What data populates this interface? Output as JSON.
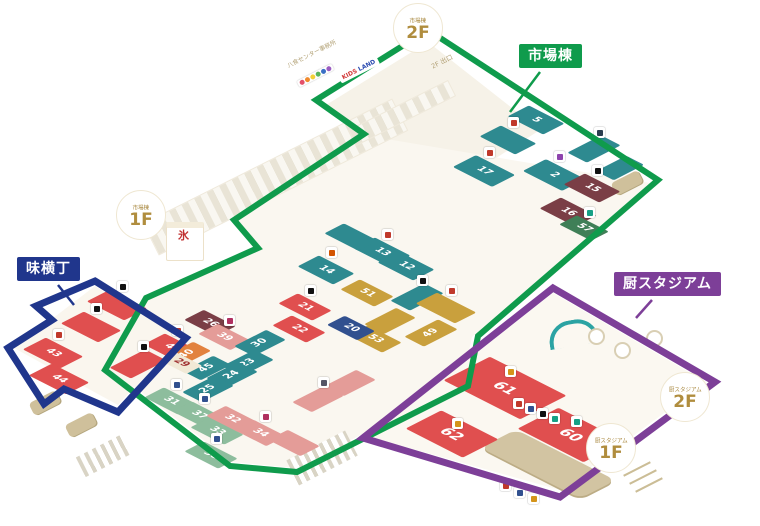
{
  "palette": {
    "teal": "#2e8a90",
    "red": "#e04f4f",
    "pink": "#e49c98",
    "maroon": "#7a3e46",
    "gold": "#c9a03d",
    "green": "#3f7f57",
    "lgreen": "#8dbd9d",
    "orange": "#e2823e",
    "navy": "#31508f",
    "cream": "#f1e9d6"
  },
  "regions": [
    {
      "name": "市場棟",
      "color": "#0f9b4c",
      "stroke": 6,
      "polygon": "428,30 316,100 364,134 234,220 258,248 146,298 105,370 230,466 297,472 468,386 478,336 658,180",
      "pointer": {
        "x1": 540,
        "y1": 72,
        "x2": 510,
        "y2": 112
      }
    },
    {
      "name": "味横丁",
      "color": "#20368c",
      "stroke": 7,
      "polygon": "95,281 186,338 118,412 64,389 44,404 8,348 52,320 36,306",
      "pointer": {
        "x1": 58,
        "y1": 285,
        "x2": 74,
        "y2": 305
      }
    },
    {
      "name": "厨スタジアム",
      "color": "#7d3f98",
      "stroke": 7,
      "polygon": "553,288 715,382 560,497 363,438",
      "pointer": {
        "x1": 652,
        "y1": 300,
        "x2": 636,
        "y2": 318
      }
    }
  ],
  "floors": [
    {
      "points": "428,42 326,105 452,186 540,130",
      "fill": "#f6f2e8"
    },
    {
      "points": "368,136 236,219 258,248 148,298 110,368 232,462 296,468 462,383 472,337 650,183",
      "fill": "#faf7f0"
    },
    {
      "points": "95,286 179,338 118,405 14,348",
      "fill": "#faf6ee"
    },
    {
      "points": "553,293 706,382 560,490 370,437",
      "fill": "#fbf8f1"
    }
  ],
  "badges": [
    {
      "building": "市場棟",
      "floor": "2F",
      "x": 393,
      "y": 3
    },
    {
      "building": "市場棟",
      "floor": "1F",
      "x": 116,
      "y": 190
    },
    {
      "building": "厨スタジアム",
      "floor": "2F",
      "x": 660,
      "y": 372
    },
    {
      "building": "厨スタジアム",
      "floor": "1F",
      "x": 586,
      "y": 423
    }
  ],
  "annotations": [
    {
      "text": "八食センター事務所",
      "x": 288,
      "y": 64,
      "rot": -27,
      "size": 6,
      "color": "#b3a277"
    },
    {
      "text": "2F 出口",
      "x": 432,
      "y": 64,
      "rot": -27,
      "size": 6.5,
      "color": "#b3a277"
    },
    {
      "text": "氷",
      "x": 178,
      "y": 230,
      "rot": 0,
      "size": 11,
      "color": "#c03030",
      "bold": true
    },
    {
      "text": "KIDS LAND",
      "x": 340,
      "y": 76,
      "rot": -27,
      "size": 6,
      "style": "kids"
    }
  ],
  "stalls": [
    {
      "n": "",
      "x": 488,
      "y": 128,
      "w": 40,
      "h": 24,
      "c": "teal",
      "d": "b",
      "chip": "#c0392b"
    },
    {
      "n": "5",
      "x": 516,
      "y": 108,
      "w": 40,
      "h": 24,
      "c": "teal",
      "d": "b"
    },
    {
      "n": "2",
      "x": 532,
      "y": 162,
      "w": 44,
      "h": 26,
      "c": "teal",
      "d": "b",
      "chip": "#8e44ad"
    },
    {
      "n": "17",
      "x": 462,
      "y": 158,
      "w": 44,
      "h": 26,
      "c": "teal",
      "d": "b",
      "chip": "#c0392b"
    },
    {
      "n": "",
      "x": 575,
      "y": 138,
      "w": 38,
      "h": 22,
      "c": "teal",
      "d": "a",
      "chip": "#2c3e50"
    },
    {
      "n": "",
      "x": 603,
      "y": 158,
      "w": 34,
      "h": 20,
      "c": "teal",
      "d": "a"
    },
    {
      "n": "15",
      "x": 572,
      "y": 176,
      "w": 40,
      "h": 24,
      "c": "maroon",
      "d": "b",
      "chip": "#111111"
    },
    {
      "n": "16",
      "x": 548,
      "y": 200,
      "w": 40,
      "h": 24,
      "c": "maroon",
      "d": "b"
    },
    {
      "n": "57",
      "x": 566,
      "y": 218,
      "w": 36,
      "h": 20,
      "c": "green",
      "d": "b",
      "chip": "#16a085"
    },
    {
      "n": "13",
      "x": 362,
      "y": 240,
      "w": 40,
      "h": 24,
      "c": "teal",
      "d": "b",
      "chip": "#c0392b"
    },
    {
      "n": "12",
      "x": 386,
      "y": 254,
      "w": 40,
      "h": 24,
      "c": "teal",
      "d": "b"
    },
    {
      "n": "14",
      "x": 306,
      "y": 258,
      "w": 40,
      "h": 24,
      "c": "teal",
      "d": "b",
      "chip": "#d35400"
    },
    {
      "n": "",
      "x": 332,
      "y": 226,
      "w": 38,
      "h": 22,
      "c": "teal",
      "d": "b"
    },
    {
      "n": "51",
      "x": 348,
      "y": 282,
      "w": 38,
      "h": 22,
      "c": "gold",
      "d": "b"
    },
    {
      "n": "",
      "x": 398,
      "y": 286,
      "w": 38,
      "h": 22,
      "c": "teal",
      "d": "a",
      "chip": "#111111"
    },
    {
      "n": "",
      "x": 372,
      "y": 310,
      "w": 36,
      "h": 22,
      "c": "gold",
      "d": "a"
    },
    {
      "n": "49",
      "x": 412,
      "y": 322,
      "w": 38,
      "h": 22,
      "c": "gold",
      "d": "a"
    },
    {
      "n": "53",
      "x": 356,
      "y": 328,
      "w": 38,
      "h": 22,
      "c": "gold",
      "d": "b"
    },
    {
      "n": "20",
      "x": 334,
      "y": 318,
      "w": 34,
      "h": 20,
      "c": "navy",
      "d": "b"
    },
    {
      "n": "21",
      "x": 286,
      "y": 296,
      "w": 38,
      "h": 22,
      "c": "red",
      "d": "b",
      "chip": "#111111"
    },
    {
      "n": "22",
      "x": 280,
      "y": 318,
      "w": 38,
      "h": 22,
      "c": "red",
      "d": "b"
    },
    {
      "n": "26",
      "x": 192,
      "y": 312,
      "w": 36,
      "h": 22,
      "c": "maroon",
      "d": "b"
    },
    {
      "n": "39",
      "x": 206,
      "y": 326,
      "w": 36,
      "h": 22,
      "c": "pink",
      "d": "b",
      "chip": "#b03060"
    },
    {
      "n": "46",
      "x": 152,
      "y": 336,
      "w": 40,
      "h": 24,
      "c": "red",
      "d": "b",
      "chip": "#c0392b"
    },
    {
      "n": "40",
      "x": 170,
      "y": 344,
      "w": 34,
      "h": 20,
      "c": "orange",
      "d": "a"
    },
    {
      "n": "30",
      "x": 242,
      "y": 332,
      "w": 36,
      "h": 22,
      "c": "teal",
      "d": "a"
    },
    {
      "n": "23",
      "x": 230,
      "y": 352,
      "w": 36,
      "h": 22,
      "c": "teal",
      "d": "a"
    },
    {
      "n": "24",
      "x": 214,
      "y": 364,
      "w": 36,
      "h": 22,
      "c": "teal",
      "d": "a"
    },
    {
      "n": "45",
      "x": 190,
      "y": 358,
      "w": 34,
      "h": 20,
      "c": "teal",
      "d": "a"
    },
    {
      "n": "25",
      "x": 190,
      "y": 378,
      "w": 36,
      "h": 22,
      "c": "teal",
      "d": "a"
    },
    {
      "n": "29",
      "x": 166,
      "y": 354,
      "w": 30,
      "h": 18,
      "c": "cream",
      "d": "b",
      "tc": "#a03333"
    },
    {
      "n": "31",
      "x": 152,
      "y": 390,
      "w": 38,
      "h": 22,
      "c": "lgreen",
      "d": "b",
      "chip": "#31508f"
    },
    {
      "n": "37",
      "x": 180,
      "y": 404,
      "w": 38,
      "h": 22,
      "c": "lgreen",
      "d": "b",
      "chip": "#31508f"
    },
    {
      "n": "33",
      "x": 198,
      "y": 420,
      "w": 38,
      "h": 22,
      "c": "lgreen",
      "d": "b"
    },
    {
      "n": "38",
      "x": 192,
      "y": 444,
      "w": 38,
      "h": 22,
      "c": "lgreen",
      "d": "b",
      "chip": "#31508f"
    },
    {
      "n": "32",
      "x": 214,
      "y": 408,
      "w": 36,
      "h": 22,
      "c": "pink",
      "d": "b"
    },
    {
      "n": "34",
      "x": 242,
      "y": 422,
      "w": 36,
      "h": 22,
      "c": "pink",
      "d": "b",
      "chip": "#b03060"
    },
    {
      "n": "",
      "x": 276,
      "y": 432,
      "w": 36,
      "h": 22,
      "c": "pink",
      "d": "b"
    },
    {
      "n": "",
      "x": 300,
      "y": 388,
      "w": 36,
      "h": 22,
      "c": "pink",
      "d": "a",
      "chip": "#555566"
    },
    {
      "n": "",
      "x": 332,
      "y": 372,
      "w": 36,
      "h": 22,
      "c": "pink",
      "d": "a"
    },
    {
      "n": "",
      "x": 96,
      "y": 292,
      "w": 42,
      "h": 26,
      "c": "red",
      "d": "b",
      "chip": "#111111"
    },
    {
      "n": "",
      "x": 70,
      "y": 314,
      "w": 42,
      "h": 26,
      "c": "red",
      "d": "b",
      "chip": "#111111"
    },
    {
      "n": "43",
      "x": 32,
      "y": 340,
      "w": 42,
      "h": 26,
      "c": "red",
      "d": "b",
      "chip": "#c0392b"
    },
    {
      "n": "44",
      "x": 38,
      "y": 366,
      "w": 42,
      "h": 26,
      "c": "red",
      "d": "b"
    },
    {
      "n": "",
      "x": 118,
      "y": 352,
      "w": 40,
      "h": 24,
      "c": "red",
      "d": "a",
      "chip": "#111111"
    },
    {
      "n": "",
      "x": 424,
      "y": 296,
      "w": 44,
      "h": 24,
      "c": "gold",
      "d": "b",
      "chip": "#c0392b"
    },
    {
      "n": "61",
      "x": 462,
      "y": 362,
      "w": 86,
      "h": 52,
      "c": "red",
      "d": "b",
      "big": true,
      "chip": "#d4941a"
    },
    {
      "n": "60",
      "x": 534,
      "y": 412,
      "w": 74,
      "h": 46,
      "c": "red",
      "d": "b",
      "big": true,
      "chip": "#16a085"
    },
    {
      "n": "62",
      "x": 420,
      "y": 414,
      "w": 64,
      "h": 40,
      "c": "red",
      "d": "b",
      "big": true,
      "chip": "#d4941a"
    }
  ],
  "free_chips": [
    {
      "x": 513,
      "y": 398,
      "c": "#c0392b"
    },
    {
      "x": 525,
      "y": 403,
      "c": "#31508f"
    },
    {
      "x": 537,
      "y": 408,
      "c": "#111111"
    },
    {
      "x": 549,
      "y": 413,
      "c": "#16a085"
    },
    {
      "x": 500,
      "y": 480,
      "c": "#c0392b"
    },
    {
      "x": 514,
      "y": 487,
      "c": "#31508f"
    },
    {
      "x": 528,
      "y": 493,
      "c": "#d4941a"
    }
  ],
  "gacha_colors": [
    "#e4506a",
    "#f08a2e",
    "#f2d038",
    "#57b45c",
    "#3a6fc4",
    "#9a5cc0"
  ]
}
